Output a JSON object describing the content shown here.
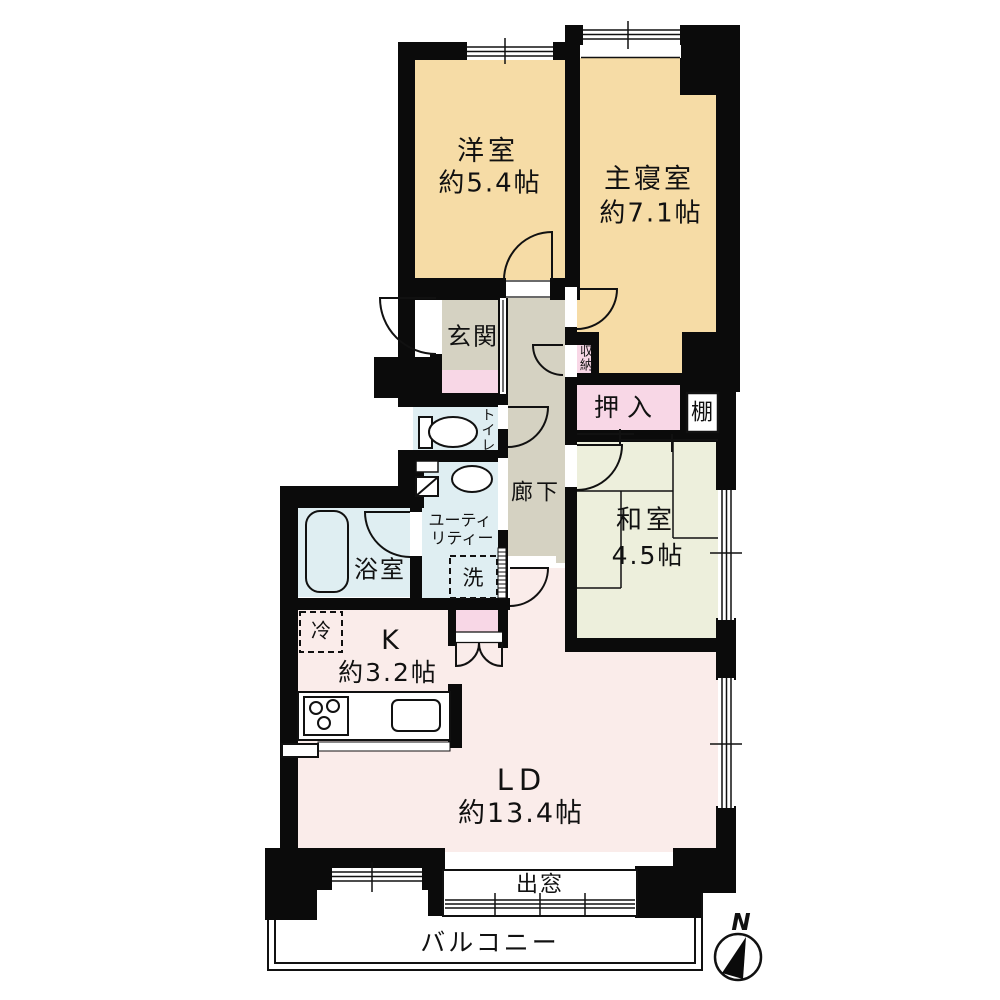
{
  "title": "マンション間取り図",
  "colors": {
    "wall": "#0b0b0b",
    "beige": "#f6dca6",
    "gray": "#d5d2c2",
    "pink": "#f8d7e6",
    "blue": "#dfeef2",
    "green": "#edefdc",
    "ld": "#faecea",
    "line": "#111111"
  },
  "rooms": {
    "western": {
      "name": "洋室",
      "size": "約5.4帖"
    },
    "master": {
      "name": "主寝室",
      "size": "約7.1帖"
    },
    "entrance": {
      "name": "玄関"
    },
    "storage": {
      "name": "収納"
    },
    "oshiire": {
      "name": "押入"
    },
    "shelf": {
      "name": "棚"
    },
    "hallway": {
      "name": "廊下"
    },
    "toilet": {
      "name": "トイレ"
    },
    "japanese": {
      "name": "和室",
      "size": "4.5帖"
    },
    "utility": {
      "name": "ユーティリティー",
      "line1": "ユーティ",
      "line2": "リティー"
    },
    "washer": {
      "name": "洗"
    },
    "bath": {
      "name": "浴室"
    },
    "fridge": {
      "name": "冷"
    },
    "kitchen": {
      "name": "K",
      "size": "約3.2帖"
    },
    "living": {
      "name": "LD",
      "size": "約13.4帖"
    },
    "baywindow": {
      "name": "出窓"
    },
    "balcony": {
      "name": "バルコニー"
    }
  },
  "compass": {
    "north": "N"
  }
}
